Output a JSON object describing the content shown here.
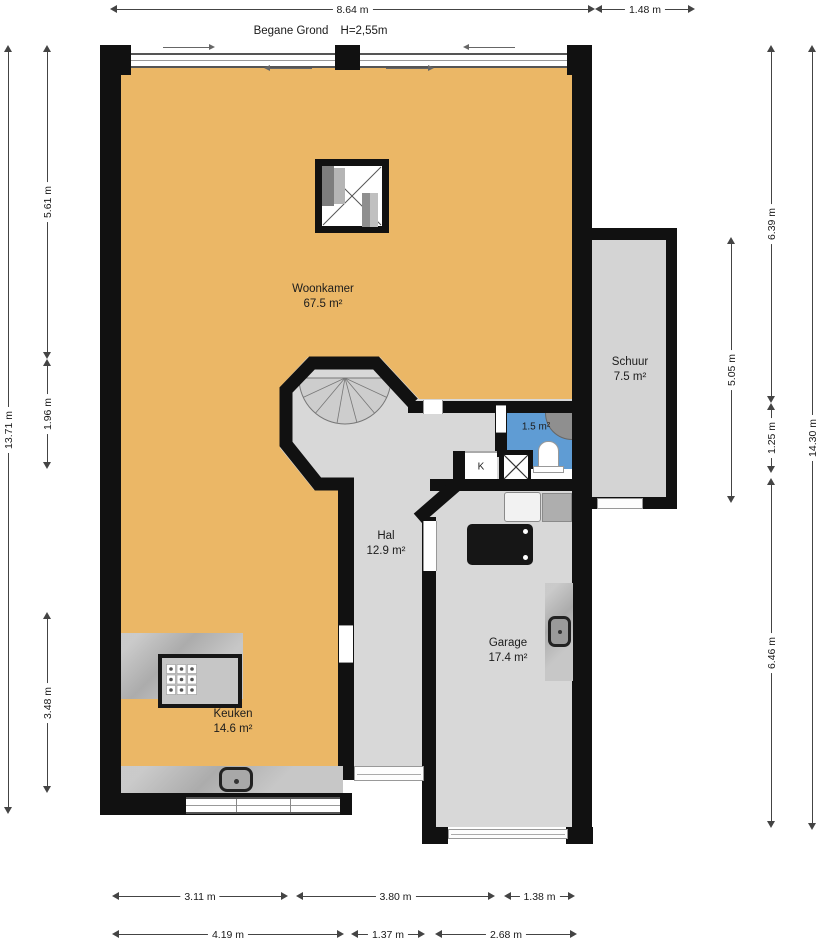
{
  "header": {
    "title": "Begane Grond",
    "ceiling_height": "H=2,55m"
  },
  "rooms": {
    "woonkamer": {
      "name": "Woonkamer",
      "area": "67.5 m²"
    },
    "keuken": {
      "name": "Keuken",
      "area": "14.6 m²"
    },
    "hal": {
      "name": "Hal",
      "area": "12.9 m²"
    },
    "garage": {
      "name": "Garage",
      "area": "17.4 m²"
    },
    "schuur": {
      "name": "Schuur",
      "area": "7.5 m²"
    },
    "toilet": {
      "area": "1.5 m²"
    },
    "kast": {
      "name": "K"
    }
  },
  "dimensions": {
    "top": [
      {
        "label": "8.64 m"
      },
      {
        "label": "1.48 m"
      }
    ],
    "left": [
      {
        "label": "5.61 m"
      },
      {
        "label": "1.96 m"
      },
      {
        "label": "3.48 m"
      },
      {
        "label": "13.71 m"
      }
    ],
    "right": [
      {
        "label": "6.39 m"
      },
      {
        "label": "5.05 m"
      },
      {
        "label": "1.25 m"
      },
      {
        "label": "6.46 m"
      },
      {
        "label": "14.30 m"
      }
    ],
    "bottom_upper": [
      {
        "label": "3.11 m"
      },
      {
        "label": "3.80 m"
      },
      {
        "label": "1.38 m"
      }
    ],
    "bottom_lower": [
      {
        "label": "4.19 m"
      },
      {
        "label": "1.37 m"
      },
      {
        "label": "2.68 m"
      }
    ]
  },
  "colors": {
    "wall": "#111111",
    "floor_living": "#ebb766",
    "floor_circulation": "#d8d8d8",
    "floor_shed": "#d4d4d4",
    "floor_toilet": "#5f9cd4",
    "counter": "#b9b9b9",
    "appliance_dark": "#161616"
  }
}
